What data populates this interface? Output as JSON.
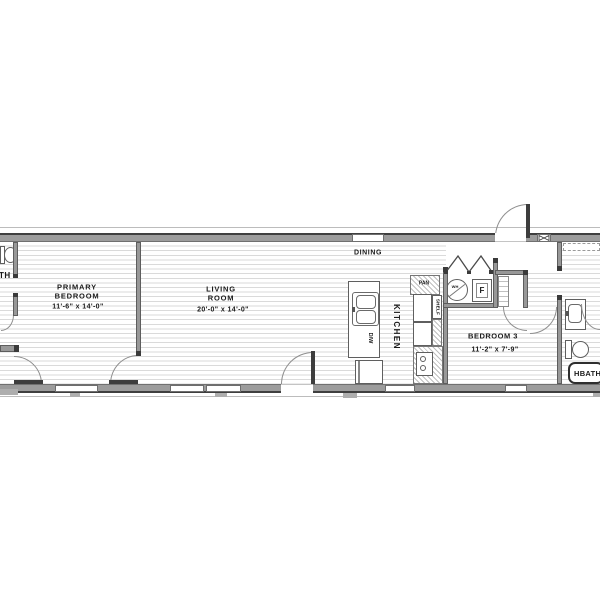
{
  "title": "single-wide manufactured home floor plan",
  "rooms": {
    "primary_bedroom": {
      "name_line1": "PRIMARY",
      "name_line2": "BEDROOM",
      "dims": "11'-6\" x  14'-0\""
    },
    "living_room": {
      "name_line1": "LIVING",
      "name_line2": "ROOM",
      "dims": "20'-0\" x  14'-0\""
    },
    "dining": {
      "name": "DINING"
    },
    "kitchen": {
      "name": "KITCHEN"
    },
    "bedroom3": {
      "name": "BEDROOM 3",
      "dims": "11'-2\" x  7'-9\""
    },
    "hall_bath": {
      "name": "HBATH"
    },
    "primary_bath_partial": {
      "name": "TH"
    }
  },
  "fixtures": {
    "pantry": "PAN",
    "shelf": "SHELF",
    "dishwasher": "D/W",
    "water_heater": "WH",
    "furnace": "F"
  },
  "colors": {
    "wall_gray": "#9c9c9c",
    "wall_dark": "#3f3f3f",
    "floor_line": "#dadada",
    "door_arc": "#8f8f8f",
    "text": "#1a1a1a",
    "background": "#ffffff"
  }
}
